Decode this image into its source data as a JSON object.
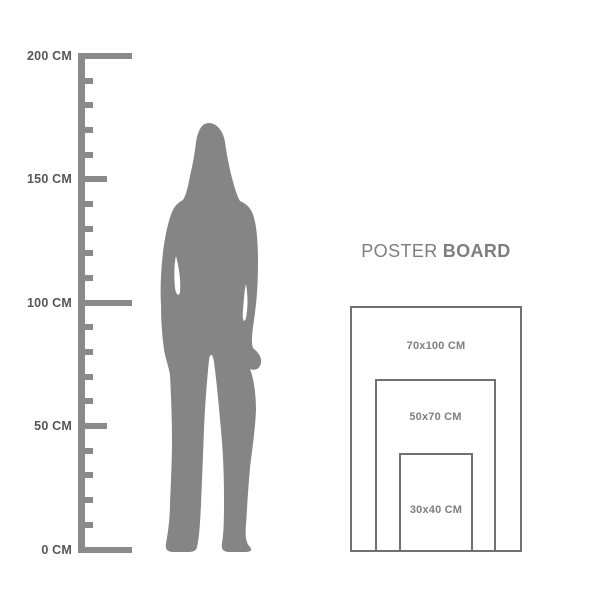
{
  "colors": {
    "background": "#ffffff",
    "figure_gray": "#858585",
    "ruler_gray": "#8a8a8a",
    "ruler_label": "#565656",
    "box_border": "#717171",
    "label_gray": "#7e7e7e"
  },
  "ruler": {
    "unit": "CM",
    "min_cm": 0,
    "max_cm": 200,
    "tick_interval_cm": 10,
    "labeled_ticks": [
      {
        "cm": 200,
        "label": "200 CM"
      },
      {
        "cm": 150,
        "label": "150 CM"
      },
      {
        "cm": 100,
        "label": "100 CM"
      },
      {
        "cm": 50,
        "label": "50 CM"
      },
      {
        "cm": 0,
        "label": "0 CM"
      }
    ]
  },
  "figure": {
    "type": "standing-woman-silhouette"
  },
  "poster_board": {
    "title": {
      "regular": "POSTER",
      "bold": "BOARD"
    },
    "sizes": [
      {
        "label": "70x100 CM"
      },
      {
        "label": "50x70 CM"
      },
      {
        "label": "30x40 CM"
      }
    ]
  }
}
